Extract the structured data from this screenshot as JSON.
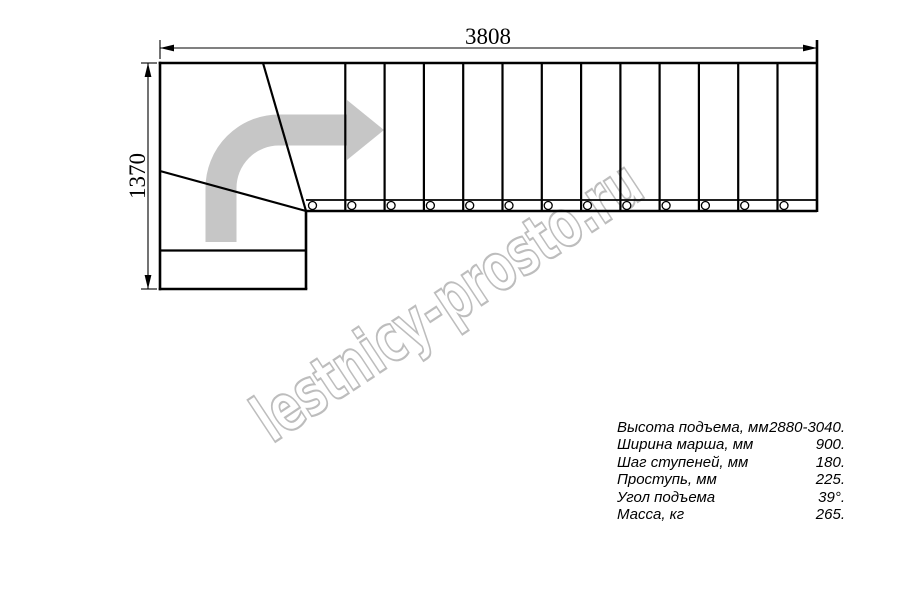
{
  "watermark": {
    "text": "lestnicy-prosto.ru",
    "color": "#bdbdbd"
  },
  "drawing": {
    "type": "staircase-plan-top-view",
    "width_label": "3808",
    "height_label": "1370",
    "straight_treads": 13,
    "baluster_markers": 13,
    "turn": "left-to-right quarter turn with winder steps",
    "direction_arrow": "up-then-right",
    "line_color": "#000000",
    "arrow_color": "#c6c6c6"
  },
  "specs": {
    "rows": [
      {
        "label": "Высота подъема, мм",
        "value": "2880-3040."
      },
      {
        "label": "Ширина марша, мм",
        "value": "900."
      },
      {
        "label": "Шаг ступеней, мм",
        "value": "180."
      },
      {
        "label": "Проступь, мм",
        "value": "225."
      },
      {
        "label": "Угол подъема",
        "value": "39°."
      },
      {
        "label": "Масса, кг",
        "value": "265."
      }
    ]
  }
}
